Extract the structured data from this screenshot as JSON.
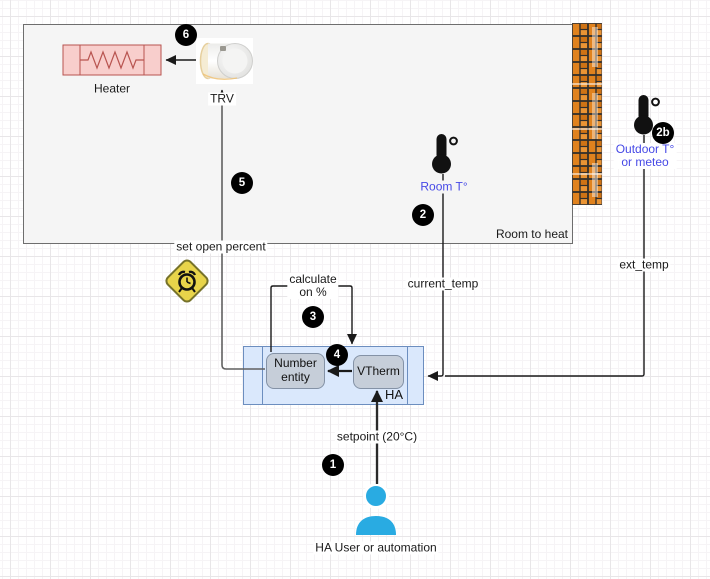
{
  "diagram": {
    "room": {
      "label": "Room to heat"
    },
    "heater": {
      "label": "Heater"
    },
    "trv": {
      "label": "TRV"
    },
    "sensors": {
      "room_label": "Room T°",
      "outdoor_label_1": "Outdoor T°",
      "outdoor_label_2": "or meteo"
    },
    "ha": {
      "label": "HA",
      "number_entity": "Number entity",
      "vtherm": "VTherm"
    },
    "user": {
      "label": "HA User or automation"
    },
    "edges": {
      "set_open_percent": "set open percent",
      "calculate_1": "calculate",
      "calculate_2": "on %",
      "current_temp": "current_temp",
      "ext_temp": "ext_temp",
      "setpoint": "setpoint (20°C)"
    },
    "badges": {
      "b1": "1",
      "b2": "2",
      "b2b": "2b",
      "b3": "3",
      "b4": "4",
      "b5": "5",
      "b6": "6"
    },
    "icons": {
      "trv": "radiator-valve-photo",
      "heater_symbol": "resistor",
      "room_sensor": "thermometer",
      "outdoor_sensor": "thermometer",
      "delay_warning": "alarm-clock-diamond",
      "wall": "brick-wall",
      "user": "person"
    },
    "colors": {
      "heater_fill": "#f8cecc",
      "heater_stroke": "#b85450",
      "ha_fill": "#dae8fc",
      "ha_stroke": "#6c8ebf",
      "node_fill": "#c6ced9",
      "node_stroke": "#8492a6",
      "sensor_label_blue": "#4649e6",
      "person_blue": "#29abe2",
      "warning_yellow": "#e8d44a",
      "brick_orange": "#e0821e",
      "room_fill": "#f5f5f5"
    }
  }
}
